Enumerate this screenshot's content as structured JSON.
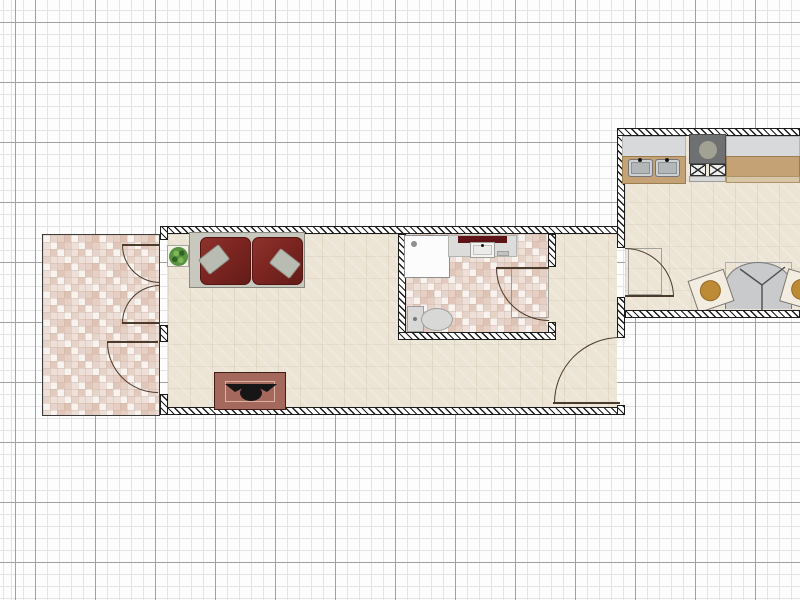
{
  "app": {
    "name": "floor-plan-editor",
    "view": "2d-plan"
  },
  "grid": {
    "minor_spacing_px": 12,
    "major_spacing_px": 60
  },
  "colors": {
    "grid_minor": "#e3e3e3",
    "grid_major": "#a0a0a1",
    "wall_fill": "#ffffff",
    "wall_line": "#1c1c1c",
    "floor_parquet": "#ece4d5",
    "floor_tile_base": "#f8f3ef",
    "door_arc": "#4a3b2a",
    "sofa_cushion": "#7c2521",
    "sofa_frame": "#c9c8bf",
    "sofa_pillow": "#b9bcb2",
    "plant_foliage": "#4c8a3f",
    "fireplace_body": "#a4685c",
    "fixture_grey": "#dcdddb",
    "towel_red": "#5e1316",
    "counter_grey": "#d8d9db",
    "cabinet_wood": "#c5a276",
    "range_grey": "#6f7072",
    "sink_steel": "#b4b7ba",
    "table_grey": "#c9cacc",
    "chair_seat": "#bd8a35"
  },
  "rooms": {
    "living": "living room",
    "bathroom": "bathroom",
    "kitchen": "kitchen dining room",
    "patio": "tiled patio"
  },
  "furniture": {
    "sofa": "red two-seat sofa",
    "plant": "potted plant",
    "fireplace": "fireplace",
    "shower": "shower base",
    "bath_counter": "bathroom sink counter with towel",
    "toilet": "toilet",
    "kitchen_sink": "double kitchen sink",
    "range": "range cooktop",
    "counter": "kitchen counter",
    "table": "round dining table",
    "chair": "dining chair"
  },
  "doors": {
    "patio_double": "double door to patio",
    "patio_single": "single door to patio",
    "bathroom": "bathroom door",
    "kitchen": "kitchen door",
    "living_entry": "living room entry door"
  }
}
